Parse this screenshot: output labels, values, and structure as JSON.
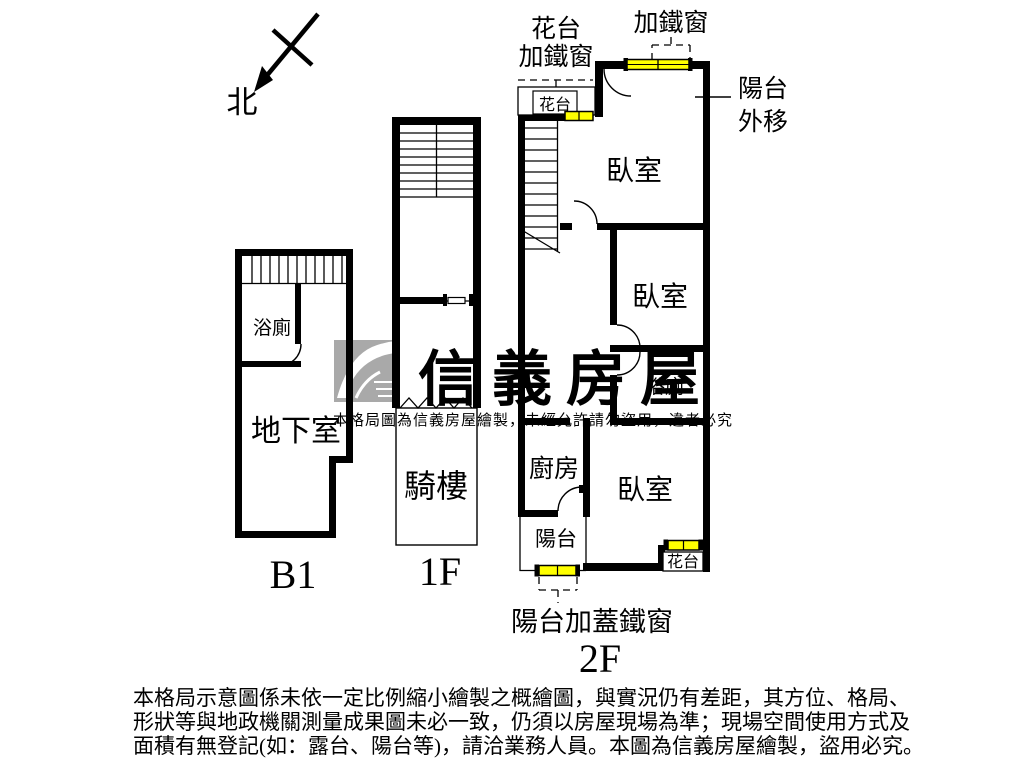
{
  "meta": {
    "background": "#ffffff",
    "wall_color": "#000000",
    "window_color": "#ffff00",
    "watermark_color": "#a9a9a9"
  },
  "compass": {
    "label": "北"
  },
  "floors": {
    "b1": {
      "name": "B1",
      "rooms": {
        "bathroom": "浴廁",
        "basement": "地下室"
      }
    },
    "f1": {
      "name": "1F",
      "rooms": {
        "arcade": "騎樓"
      }
    },
    "f2": {
      "name": "2F",
      "rooms": {
        "bedroom_top": "臥室",
        "bedroom_mid": "臥室",
        "bedroom_bottom": "臥室",
        "bathroom": "浴廁",
        "kitchen": "廚房",
        "balcony": "陽台",
        "flower_box_top": "花台",
        "flower_box_bottom": "花台"
      },
      "callouts": {
        "flower_iron_line1": "花台",
        "flower_iron_line2": "加鐵窗",
        "iron_window": "加鐵窗",
        "balcony_out_line1": "陽台",
        "balcony_out_line2": "外移",
        "balcony_cover_iron": "陽台加蓋鐵窗"
      }
    }
  },
  "watermark": {
    "brand": "信義房屋",
    "notice": "本格局圖為信義房屋繪製，未經允許請勿盜用，違者必究"
  },
  "disclaimer": {
    "line1": "本格局示意圖係未依一定比例縮小繪製之概繪圖，與實況仍有差距，其方位、格局、",
    "line2": "形狀等與地政機關測量成果圖未必一致，仍須以房屋現場為準；現場空間使用方式及",
    "line3": "面積有無登記(如：露台、陽台等)，請洽業務人員。本圖為信義房屋繪製，盜用必究。"
  }
}
